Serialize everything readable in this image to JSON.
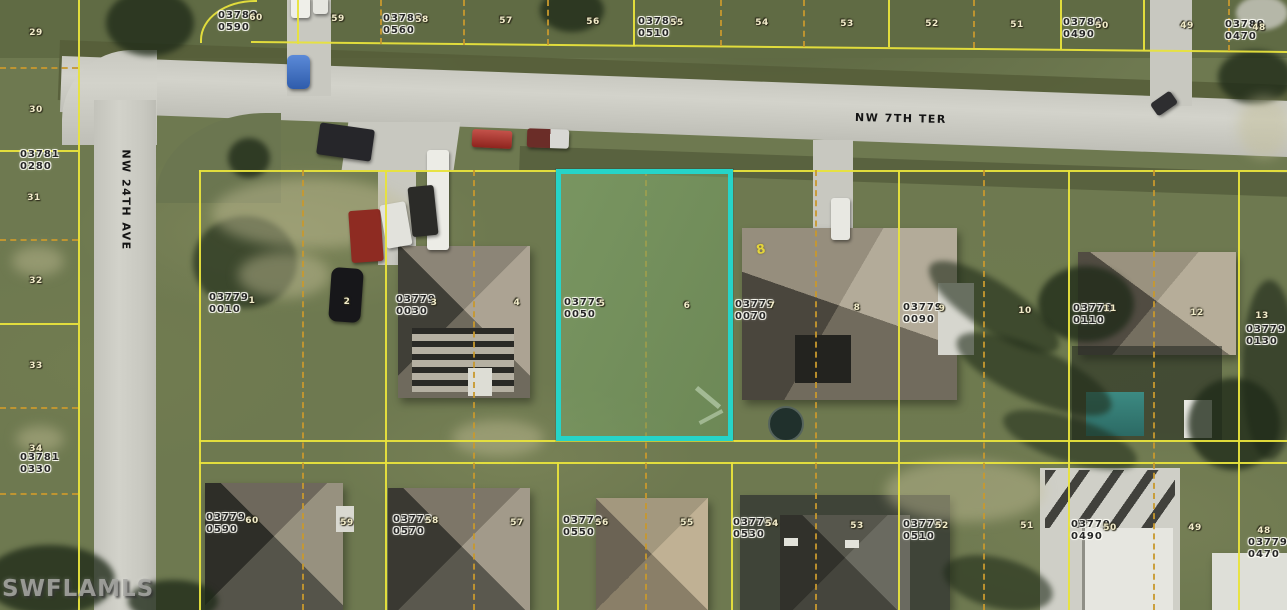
{
  "map_overlay": {
    "watermark": "SWFLAMLS",
    "streets": {
      "horizontal": {
        "name": "NW 7TH TER"
      },
      "vertical": {
        "name": "NW 24TH AVE"
      }
    },
    "highlighted_parcel": {
      "strap": "03779 0050",
      "lot_numbers_inside": [
        "5",
        "6"
      ],
      "outline_color": "#26D4C8"
    },
    "colors": {
      "parcel_line": "#E8E33C",
      "lot_split_line": "#C8992E",
      "highlight": "#26D4C8",
      "road": "#CCCCC4",
      "grass": "#6E7950",
      "label_text": "#262626",
      "lot_number_text": "#F2ECCA",
      "street_text": "#141414"
    },
    "parcel_labels": [
      {
        "line1": "03780",
        "line2": "0590",
        "x": 218,
        "y": 10
      },
      {
        "line1": "03780",
        "line2": "0560",
        "x": 383,
        "y": 13
      },
      {
        "line1": "03780",
        "line2": "0510",
        "x": 638,
        "y": 16
      },
      {
        "line1": "03780",
        "line2": "0490",
        "x": 1063,
        "y": 17
      },
      {
        "line1": "03780",
        "line2": "0470",
        "x": 1225,
        "y": 19
      },
      {
        "line1": "03781",
        "line2": "0280",
        "x": 20,
        "y": 149
      },
      {
        "line1": "03781",
        "line2": "0330",
        "x": 20,
        "y": 452
      },
      {
        "line1": "03779",
        "line2": "0010",
        "x": 209,
        "y": 292
      },
      {
        "line1": "03779",
        "line2": "0030",
        "x": 396,
        "y": 294
      },
      {
        "line1": "03779",
        "line2": "0050",
        "x": 564,
        "y": 297
      },
      {
        "line1": "03779",
        "line2": "0070",
        "x": 735,
        "y": 299
      },
      {
        "line1": "03779",
        "line2": "0090",
        "x": 903,
        "y": 302
      },
      {
        "line1": "03779",
        "line2": "0110",
        "x": 1073,
        "y": 303
      },
      {
        "line1": "03779",
        "line2": "0130",
        "x": 1246,
        "y": 324
      },
      {
        "line1": "03779",
        "line2": "0590",
        "x": 206,
        "y": 512
      },
      {
        "line1": "03779",
        "line2": "0570",
        "x": 393,
        "y": 514
      },
      {
        "line1": "03779",
        "line2": "0550",
        "x": 563,
        "y": 515
      },
      {
        "line1": "03779",
        "line2": "0530",
        "x": 733,
        "y": 517
      },
      {
        "line1": "03779",
        "line2": "0510",
        "x": 903,
        "y": 519
      },
      {
        "line1": "03779",
        "line2": "0490",
        "x": 1071,
        "y": 519
      },
      {
        "line1": "03779",
        "line2": "0470",
        "x": 1248,
        "y": 537
      }
    ],
    "lot_numbers": [
      {
        "n": "60",
        "x": 256,
        "y": 18
      },
      {
        "n": "59",
        "x": 338,
        "y": 19
      },
      {
        "n": "58",
        "x": 422,
        "y": 20
      },
      {
        "n": "57",
        "x": 506,
        "y": 21
      },
      {
        "n": "56",
        "x": 593,
        "y": 22
      },
      {
        "n": "55",
        "x": 677,
        "y": 23
      },
      {
        "n": "54",
        "x": 762,
        "y": 23
      },
      {
        "n": "53",
        "x": 847,
        "y": 24
      },
      {
        "n": "52",
        "x": 932,
        "y": 24
      },
      {
        "n": "51",
        "x": 1017,
        "y": 25
      },
      {
        "n": "50",
        "x": 1102,
        "y": 26
      },
      {
        "n": "49",
        "x": 1187,
        "y": 26
      },
      {
        "n": "48",
        "x": 1259,
        "y": 28
      },
      {
        "n": "29",
        "x": 36,
        "y": 33
      },
      {
        "n": "30",
        "x": 36,
        "y": 110
      },
      {
        "n": "31",
        "x": 34,
        "y": 198
      },
      {
        "n": "32",
        "x": 36,
        "y": 281
      },
      {
        "n": "33",
        "x": 36,
        "y": 366
      },
      {
        "n": "34",
        "x": 36,
        "y": 449
      },
      {
        "n": "1",
        "x": 252,
        "y": 301
      },
      {
        "n": "2",
        "x": 347,
        "y": 302
      },
      {
        "n": "3",
        "x": 434,
        "y": 303
      },
      {
        "n": "4",
        "x": 517,
        "y": 303
      },
      {
        "n": "5",
        "x": 602,
        "y": 304
      },
      {
        "n": "6",
        "x": 687,
        "y": 306
      },
      {
        "n": "7",
        "x": 772,
        "y": 306
      },
      {
        "n": "8",
        "x": 857,
        "y": 308
      },
      {
        "n": "9",
        "x": 942,
        "y": 309
      },
      {
        "n": "10",
        "x": 1025,
        "y": 311
      },
      {
        "n": "11",
        "x": 1110,
        "y": 309
      },
      {
        "n": "12",
        "x": 1197,
        "y": 313
      },
      {
        "n": "13",
        "x": 1262,
        "y": 316
      },
      {
        "n": "60",
        "x": 252,
        "y": 521
      },
      {
        "n": "59",
        "x": 347,
        "y": 523
      },
      {
        "n": "58",
        "x": 432,
        "y": 521
      },
      {
        "n": "57",
        "x": 517,
        "y": 523
      },
      {
        "n": "56",
        "x": 602,
        "y": 523
      },
      {
        "n": "55",
        "x": 687,
        "y": 523
      },
      {
        "n": "54",
        "x": 772,
        "y": 524
      },
      {
        "n": "53",
        "x": 857,
        "y": 526
      },
      {
        "n": "52",
        "x": 942,
        "y": 526
      },
      {
        "n": "51",
        "x": 1027,
        "y": 526
      },
      {
        "n": "50",
        "x": 1110,
        "y": 528
      },
      {
        "n": "49",
        "x": 1195,
        "y": 528
      },
      {
        "n": "48",
        "x": 1264,
        "y": 531
      }
    ],
    "marks": [
      {
        "text": "8",
        "x": 761,
        "y": 250
      }
    ]
  }
}
